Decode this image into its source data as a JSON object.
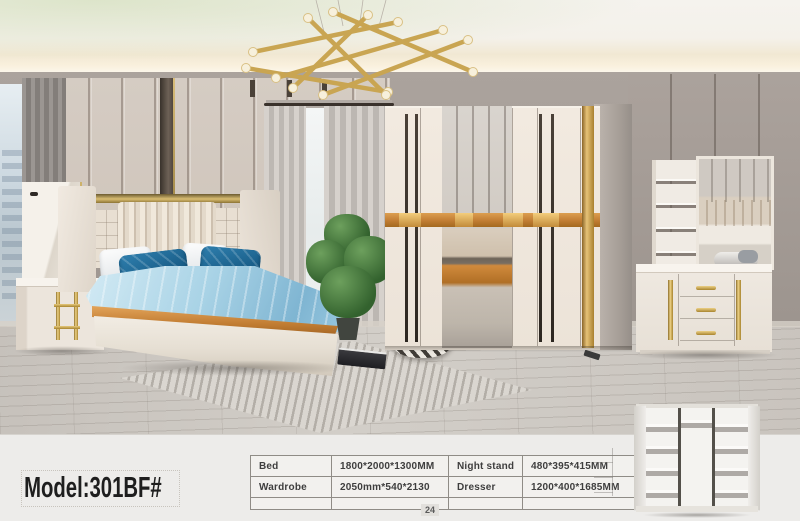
{
  "page": {
    "model_label": "Model:301BF#",
    "page_number": "24"
  },
  "spec_table": {
    "rows": [
      [
        "Bed",
        "1800*2000*1300MM",
        "Night stand",
        "480*395*415MM"
      ],
      [
        "Wardrobe",
        "2050mm*540*2130",
        "Dresser",
        "1200*400*1685MM"
      ],
      [
        "",
        "",
        "",
        ""
      ]
    ]
  },
  "scene_objects": {
    "main": "bedroom set photo: bed, nightstand, wardrobe with mirror, dresser with mirror, chandelier",
    "thumbnail": "open wardrobe interior with shelves"
  },
  "theme_colors": {
    "gold": "#c9a552",
    "wood": "#c17d33",
    "wall": "#a79f99",
    "panel": "#d5ccc3",
    "bedding": "#9ccbe2",
    "pillow": "#0c4a72",
    "floor": "#c9c4be"
  }
}
